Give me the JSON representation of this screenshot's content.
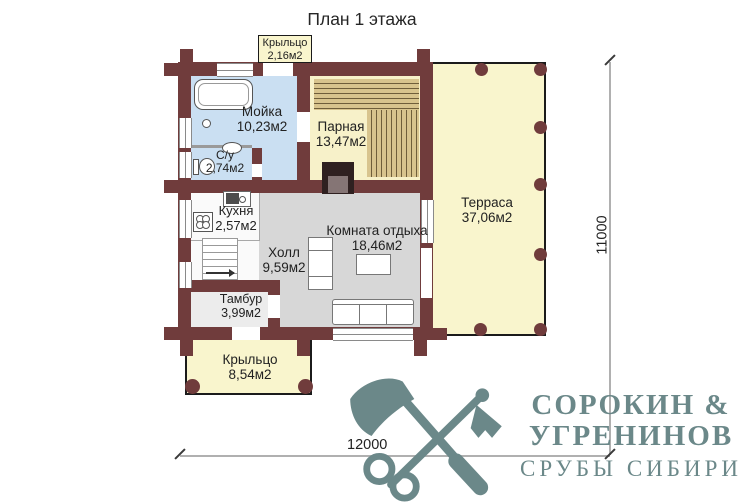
{
  "title": "План 1 этажа",
  "rooms": [
    {
      "id": "porch-top",
      "name": "Крыльцо",
      "area": "2,16м2"
    },
    {
      "id": "washroom",
      "name": "Мойка",
      "area": "10,23м2"
    },
    {
      "id": "steam-room",
      "name": "Парная",
      "area": "13,47м2"
    },
    {
      "id": "bathroom",
      "name": "С/у",
      "area": "2,74м2"
    },
    {
      "id": "kitchen",
      "name": "Кухня",
      "area": "2,57м2"
    },
    {
      "id": "terrace",
      "name": "Терраса",
      "area": "37,06м2"
    },
    {
      "id": "hall",
      "name": "Холл",
      "area": "9,59м2"
    },
    {
      "id": "lounge",
      "name": "Комната отдыха",
      "area": "18,46м2"
    },
    {
      "id": "vestibule",
      "name": "Тамбур",
      "area": "3,99м2"
    },
    {
      "id": "porch-bottom",
      "name": "Крыльцо",
      "area": "8,54м2"
    }
  ],
  "dimensions": {
    "height_label": "11000",
    "width_label": "12000"
  },
  "logo": {
    "line1": "СОРОКИН &",
    "line2": "УГРЕНИНОВ",
    "line3": "СРУБЫ СИБИРИ"
  },
  "colors": {
    "wall": "#703c3c",
    "wet_room_floor": "#cadff2",
    "steam_room_floor": "#f7f1c9",
    "bench_wood": "#d8c48e",
    "terrace_floor": "#f9f5cd",
    "hall_floor": "#d7d7d7",
    "logo": "#6b8889"
  }
}
